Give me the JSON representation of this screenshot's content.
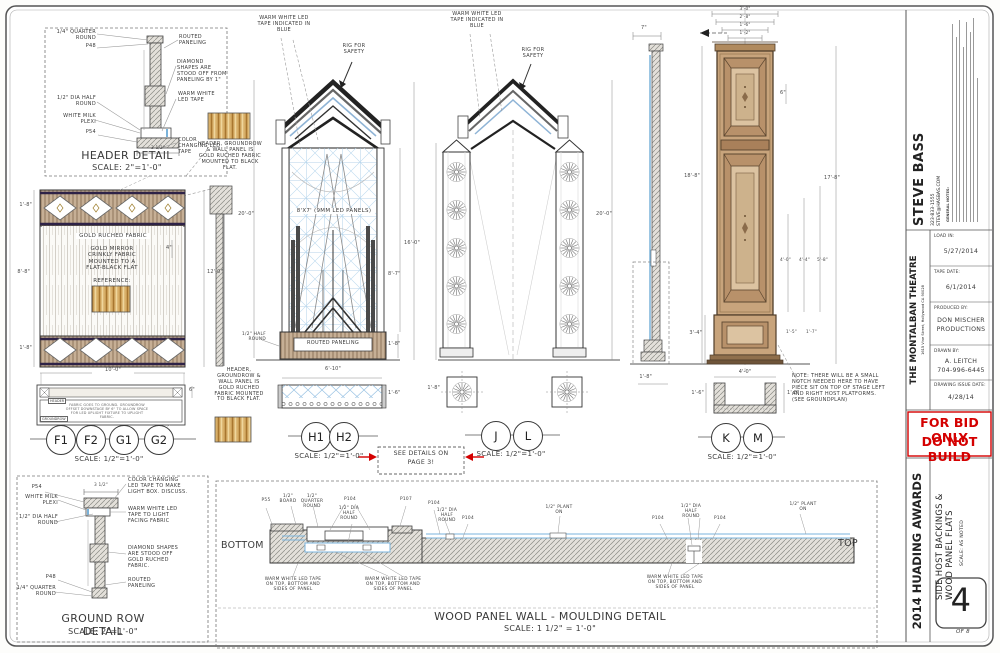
{
  "hd": {
    "qr": "1/4\" QUARTER ROUND",
    "p48": "P48",
    "routed": "ROUTED PANELING",
    "diamond": "DIAMOND SHAPES ARE STOOD OFF FROM PANELING BY 1\"",
    "hr": "1/2\" DIA HALF ROUND",
    "ww": "WARM WHITE LED TAPE",
    "plexi": "WHITE MILK PLEXI",
    "p54": "P54",
    "cc": "COLOR CHANGING LED TAPE",
    "dim": "3 1/2\"",
    "title": "HEADER DETAIL",
    "scale": "SCALE: 2\"=1'-0\""
  },
  "fnote": "HEADER, GROUNDROW & WALL PANEL IS GOLD RUCHED FABRIC MOUNTED TO BLACK FLAT.",
  "wall": {
    "ruched": "GOLD RUCHED FABRIC",
    "mirror": "GOLD MIRROR CRINKLY FABRIC MOUNTED TO A FLAT-BLACK FLAT",
    "ref": "REFERENCE:",
    "d18t": "1'-8\"",
    "d88": "8'-8\"",
    "d18b": "1'-8\"",
    "d120": "12'-0\"",
    "d4": "4\"",
    "d100": "10'-0\"",
    "d6": "6\"",
    "tagH": "HEADER",
    "tagG": "GROUNDROW",
    "plan_note": "FABRIC GOES TO GROUND. GROUNDROW OFFSET DOWNSTAGE BY 6\" TO ALLOW SPACE FOR LED UPLIGHT FIXTURE TO UPLIGHT FABRIC.",
    "f1": "F1",
    "f2": "F2",
    "g1": "G1",
    "g2": "G2",
    "scale": "SCALE: 1/2\"=1'-0\""
  },
  "pylon": {
    "ww": "WARM WHITE LED TAPE INDICATED IN BLUE",
    "rig": "RIG FOR SAFETY",
    "led": "8'X7' (9MM LED PANELS)",
    "hr": "1/2\" HALF ROUND",
    "routed": "ROUTED PANELING",
    "d200": "20'-0\"",
    "d160": "16'-0\"",
    "d87": "8'-7\"",
    "d18": "1'-8\"",
    "d610": "6'-10\"",
    "d16": "1'-6\"",
    "h1": "H1",
    "h2": "H2",
    "scale": "SCALE: 1/2\"=1'-0\""
  },
  "see": {
    "l1": "SEE DETAILS ON",
    "l2": "PAGE 3!"
  },
  "towers": {
    "ww": "WARM WHITE LED TAPE INDICATED IN BLUE",
    "rig": "RIG FOR SAFETY",
    "d200": "20'-0\"",
    "d18": "1'-8\"",
    "j": "J",
    "l": "L",
    "scale": "SCALE: 1/2\"=1'-0\""
  },
  "column": {
    "d30": "3'-0\"",
    "d28": "2'-8\"",
    "d16t": "1'-6\"",
    "d12": "1'-2\"",
    "d7": "7\"",
    "d188": "18'-8\"",
    "d178": "17'-8\"",
    "d6": "6\"",
    "d40a": "4'-0\"",
    "d44": "4'-4\"",
    "d58": "5'-8\"",
    "d34": "3'-4\"",
    "d15": "1'-5\"",
    "d17": "1'-7\"",
    "d18s": "1'-8\"",
    "d40b": "4'-0\"",
    "d16b": "1'-6\"",
    "d18b": "1'-8\"",
    "note": "NOTE: THERE WILL BE A SMALL NOTCH NEEDED HERE TO HAVE PIECE SIT ON TOP OF STAGE LEFT AND RIGHT HOST PLATFORMS. (SEE GROUNDPLAN)",
    "k": "K",
    "m": "M",
    "scale": "SCALE: 1/2\"=1'-0\""
  },
  "gr": {
    "p54": "P54",
    "plexi": "WHITE MILK PLEXI",
    "hr": "1/2\" DIA HALF ROUND",
    "cc": "COLOR CHANGING LED TAPE TO MAKE LIGHT BOX. DISCUSS.",
    "ww": "WARM WHITE LED TAPE TO LIGHT FACING FABRIC",
    "diamond": "DIAMOND SHAPES ARE STOOD OFF GOLD RUCHED FABRIC.",
    "p48": "P48",
    "qr": "1/4\" QUARTER ROUND",
    "routed": "ROUTED PANELING",
    "dim": "3 1/2\"",
    "title": "GROUND ROW DETAIL",
    "scale": "SCALE: 2\"=1'-0\""
  },
  "mould": {
    "bottom": "BOTTOM",
    "top": "TOP",
    "p55": "P55",
    "board": "1/2\" BOARD",
    "qr": "1/2\" QUARTER ROUND",
    "p104": "P104",
    "hr": "1/2\" DIA HALF ROUND",
    "p107": "P107",
    "plant": "1/2\" PLANT ON",
    "led_note": "WARM WHITE LED TAPE ON TOP, BOTTOM AND SIDES OF PANEL",
    "title": "WOOD PANEL WALL - MOULDING DETAIL",
    "scale": "SCALE: 1 1/2\" = 1'-0\""
  },
  "tb": {
    "designer": "STEVE BASS",
    "phone": "323-833-1555",
    "email": "STEVE@HASBAS.COM",
    "notes_head": "GENERAL NOTES:",
    "venue": "THE MONTALBAN THEATRE",
    "address": "1615 Vine Street, Hollywood CA 90028",
    "load_label": "LOAD IN:",
    "load": "5/27/2014",
    "tape_label": "TAPE DATE:",
    "tape": "6/1/2014",
    "prod_label": "PRODUCED BY:",
    "prod1": "DON MISCHER",
    "prod2": "PRODUCTIONS",
    "drawn_label": "DRAWN BY:",
    "drawn1": "A. LEITCH",
    "drawn2": "704-996-6445",
    "issue_label": "DRAWING ISSUE DATE:",
    "issue": "4/28/14",
    "stamp1": "FOR BID ONLY",
    "stamp2": "DO NOT BUILD",
    "show": "2014 HUADING AWARDS",
    "sheet_title1": "SIDE HOST BACKINGS &",
    "sheet_title2": "WOOD PANEL FLATS",
    "scale_note": "SCALE: AS NOTED",
    "num": "4",
    "of": "OF 8"
  },
  "colors": {
    "red": "#d40000",
    "led_blue": "#7ab3dc",
    "wood_tan": "#c8a47c",
    "gold": "#c89b52"
  }
}
